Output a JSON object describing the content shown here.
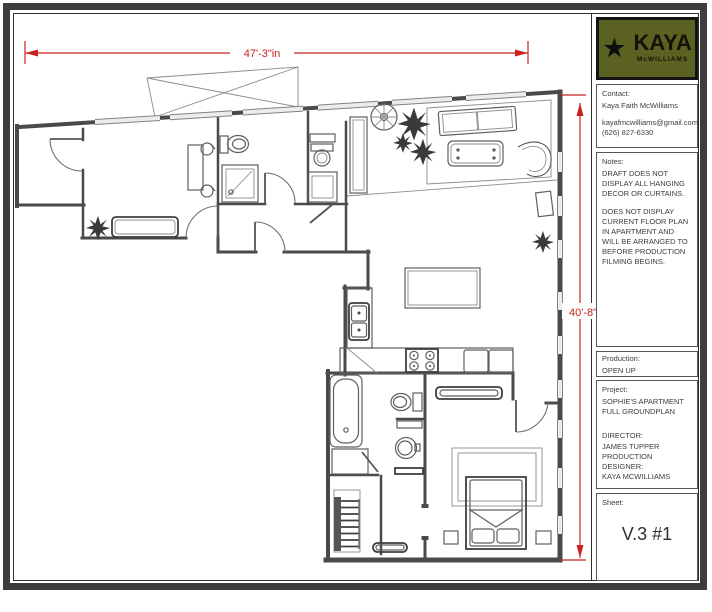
{
  "dimensions": {
    "width_label": "47'-3\"in",
    "height_label": "40'-8\"",
    "color": "#c9211e"
  },
  "title_block": {
    "logo": {
      "star_icon": "★",
      "brand": "KAYA",
      "sub_brand": "McWILLIAMS",
      "bg_color": "#5b6120"
    },
    "contact": {
      "heading": "Contact:",
      "name": "Kaya Faith McWilliams",
      "email": "kayafmcwilliams@gmail.com",
      "phone": "(626) 827-6330"
    },
    "notes": {
      "heading": "Notes:",
      "paragraph1": "DRAFT DOES NOT DISPLAY ALL HANGING DECOR OR CURTAINS.",
      "paragraph2": "DOES NOT DISPLAY CURRENT FLOOR PLAN IN APARTMENT AND WILL BE ARRANGED TO BEFORE PRODUCTION FILMING BEGINS."
    },
    "production": {
      "heading": "Production:",
      "value": "OPEN UP"
    },
    "project": {
      "heading": "Project:",
      "name_line1": "SOPHIE'S APARTMENT",
      "name_line2": "FULL GROUNDPLAN",
      "director_label": "DIRECTOR:",
      "director_name": "JAMES TUPPER",
      "designer_label_line1": "PRODUCTION",
      "designer_label_line2": "DESIGNER:",
      "designer_name": "KAYA MCWILLIAMS"
    },
    "sheet": {
      "heading": "Sheet:",
      "value": "V.3 #1"
    }
  },
  "floor_plan": {
    "fixtures": [
      "bathtub",
      "shower-stall",
      "toilet",
      "toilet",
      "toilet",
      "pedestal-sink",
      "kitchen-double-sink",
      "stove",
      "kitchen-island",
      "kitchen-counter",
      "bed",
      "living-sofa",
      "daybed",
      "coffee-table",
      "curved-chair",
      "side-table",
      "window-bench",
      "pantry-cabinet",
      "wall-cabinet",
      "closet-shelves",
      "doormat",
      "plants",
      "stage-flat"
    ]
  }
}
